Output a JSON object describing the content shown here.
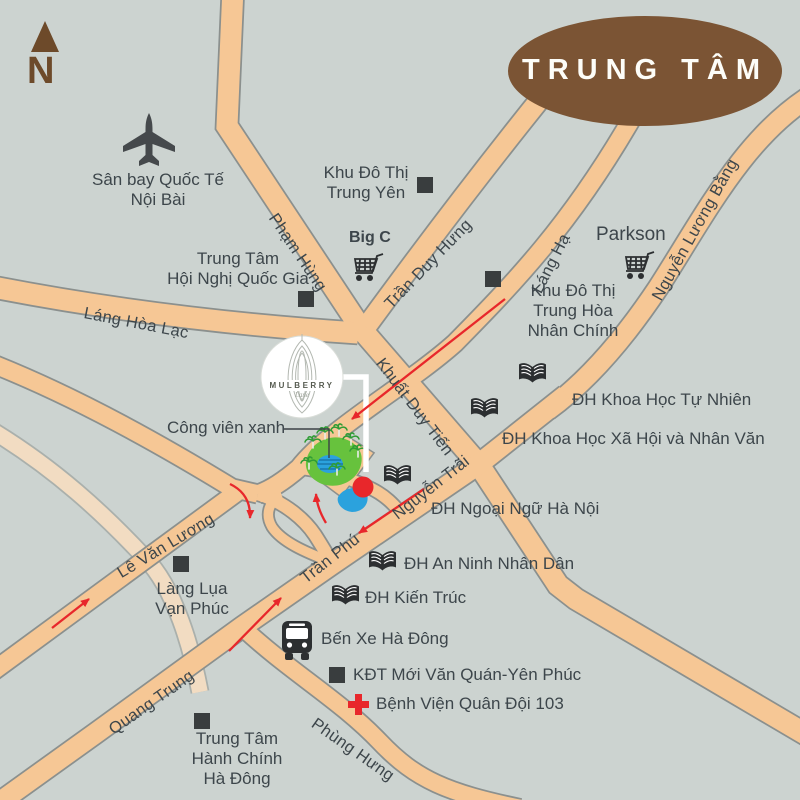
{
  "title": "Mulberry Lane location map",
  "colors": {
    "background": "#ccd3d0",
    "road": "#f6c795",
    "road_faded": "#f2dcc2",
    "road_casing": "#8b908e",
    "label": "#3d464b",
    "route_red": "#e8272b",
    "badge_brown": "#7b5434",
    "compass_brown": "#6d4a2a",
    "water_blue": "#2ba2dd",
    "park_green": "#67c23d",
    "icon_dark": "#2c2f31"
  },
  "compass": {
    "label": "N"
  },
  "center_badge": {
    "label": "TRUNG TÂM"
  },
  "project": {
    "name": "MULBERRY",
    "subname": "Lane"
  },
  "roads": {
    "pham_hung": "Phạm Hùng",
    "tran_duy_hung": "Trần Duy Hưng",
    "lang_ha": "Láng Hạ",
    "nguyen_luong_bang": "Nguyễn Lương Bằng",
    "lang_hoa_lac": "Láng Hòa Lạc",
    "khuat_duy_tien": "Khuất Duy Tiến",
    "nguyen_trai": "Nguyễn Trãi",
    "tran_phu": "Trần Phú",
    "le_van_luong": "Lê Văn Lương",
    "quang_trung": "Quang Trung",
    "phung_hung": "Phùng Hưng"
  },
  "places": {
    "airport": {
      "line1": "Sân bay Quốc Tế",
      "line2": "Nội Bài"
    },
    "trung_yen": {
      "line1": "Khu Đô Thị",
      "line2": "Trung Yên"
    },
    "convention": {
      "line1": "Trung Tâm",
      "line2": "Hội Nghị Quốc Gia"
    },
    "big_c": {
      "label": "Big C"
    },
    "parkson": {
      "label": "Parkson"
    },
    "trung_hoa": {
      "line1": "Khu Đô Thị",
      "line2": "Trung Hòa",
      "line3": "Nhân Chính"
    },
    "uni_natural_science": {
      "label": "ĐH Khoa Học Tự Nhiên"
    },
    "uni_social_science": {
      "label": "ĐH Khoa Học Xã Hội và Nhân Văn"
    },
    "uni_foreign_language": {
      "label": "ĐH Ngoại Ngữ Hà Nội"
    },
    "uni_security": {
      "label": "ĐH An Ninh Nhân Dân"
    },
    "uni_architecture": {
      "label": "ĐH Kiến Trúc"
    },
    "green_park": {
      "label": "Công viên xanh"
    },
    "silk_village": {
      "line1": "Làng Lụa",
      "line2": "Vạn Phúc"
    },
    "bus_station": {
      "label": "Bến Xe Hà Đông"
    },
    "new_urban": {
      "label": "KĐT Mới Văn Quán-Yên Phúc"
    },
    "hospital": {
      "label": "Bệnh Viện Quân Đội 103"
    },
    "admin_center": {
      "line1": "Trung Tâm",
      "line2": "Hành Chính",
      "line3": "Hà Đông"
    }
  }
}
